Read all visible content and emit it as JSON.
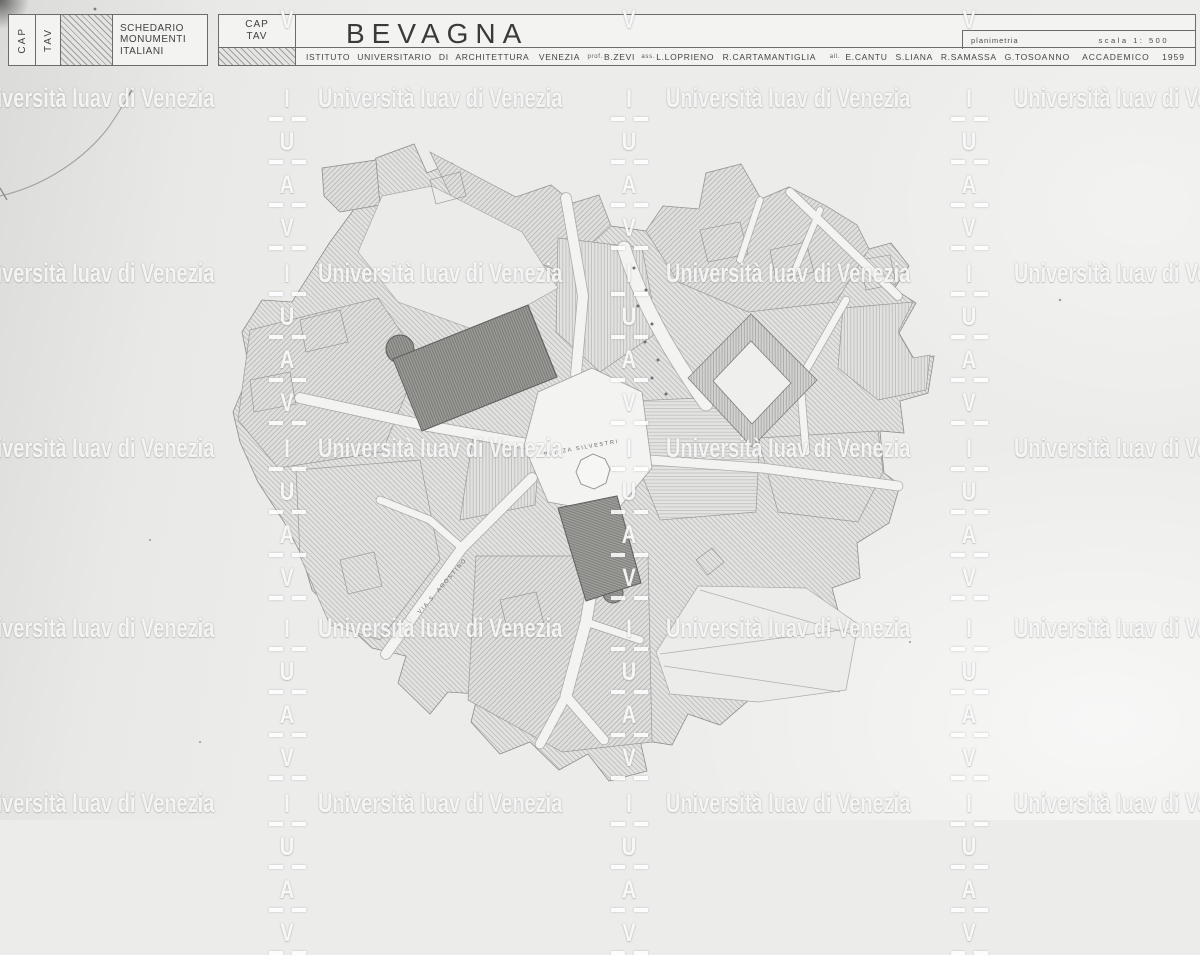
{
  "header": {
    "col_cap": "CAP",
    "col_tav": "TAV",
    "index_lines": [
      "SCHEDARIO",
      "MONUMENTI",
      "ITALIANI"
    ],
    "cap_tav_lines": [
      "CAP",
      "TAV"
    ],
    "title": "BEVAGNA",
    "drawing_type": "planimetria",
    "scale_label": "scala 1: 500",
    "institute": "ISTITUTO UNIVERSITARIO DI ARCHITETTURA",
    "city": "VENEZIA",
    "prof_label": "prof.",
    "prof_name": "B.ZEVI",
    "assistant_label": "ass.",
    "assistant_name": "L.LOPRIENO",
    "assistant2_name": "R.CARTAMANTIGLIA",
    "students_label": "all.",
    "students": [
      "E.CANTU",
      "S.LIANA",
      "R.SAMASSA",
      "G.TOSO"
    ],
    "year_label": "ANNO ACCADEMICO 1959"
  },
  "map": {
    "piazza_label": "PIAZZA SILVESTRI",
    "via_label": "VIA S. AGOSTINO"
  },
  "watermark": {
    "text": "Università Iuav di Venezia",
    "vertical_letters": [
      "I",
      "U",
      "A",
      "V"
    ]
  }
}
